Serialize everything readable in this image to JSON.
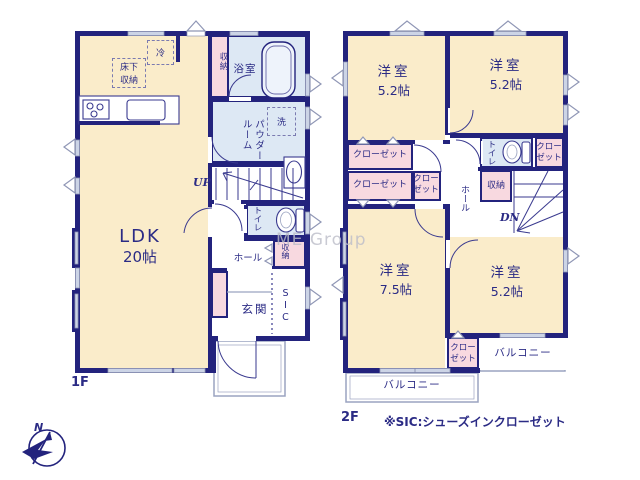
{
  "meta": {
    "floor1_label": "1F",
    "floor2_label": "2F",
    "footnote": "※SIC:シューズインクローゼット",
    "compass_north": "N",
    "watermark": "ME Group"
  },
  "floor1": {
    "ldk": {
      "name": "LDK",
      "size": "20帖"
    },
    "fridge": "冷",
    "underfloor_storage": "床下収納",
    "storage_top": "収納",
    "bath": "浴室",
    "washer": "洗",
    "powder_room": "パウダールーム",
    "stairs_up": "UP",
    "toilet": "トイレ",
    "hall": "ホール",
    "hall_storage": "収納",
    "entrance": "玄関",
    "sic": "SIC"
  },
  "floor2": {
    "rooms": [
      {
        "name": "洋室",
        "size": "5.2帖"
      },
      {
        "name": "洋室",
        "size": "5.2帖"
      },
      {
        "name": "洋室",
        "size": "7.5帖"
      },
      {
        "name": "洋室",
        "size": "5.2帖"
      }
    ],
    "closet": "クローゼット",
    "toilet": "トイレ",
    "storage": "収納",
    "hall": "ホール",
    "stairs_down": "DN",
    "balcony": "バルコニー"
  },
  "colors": {
    "wall": "#23237d",
    "room_cream": "#faecca",
    "room_pink": "#f8d9e0",
    "room_blue": "#dde8f4",
    "window": "#ccd4e6",
    "line": "#3a3a8f",
    "text": "#2b2b85",
    "balcony_line": "#9aa3c0",
    "watermark": "#bcbdc9",
    "marker": "#8f96b5"
  }
}
